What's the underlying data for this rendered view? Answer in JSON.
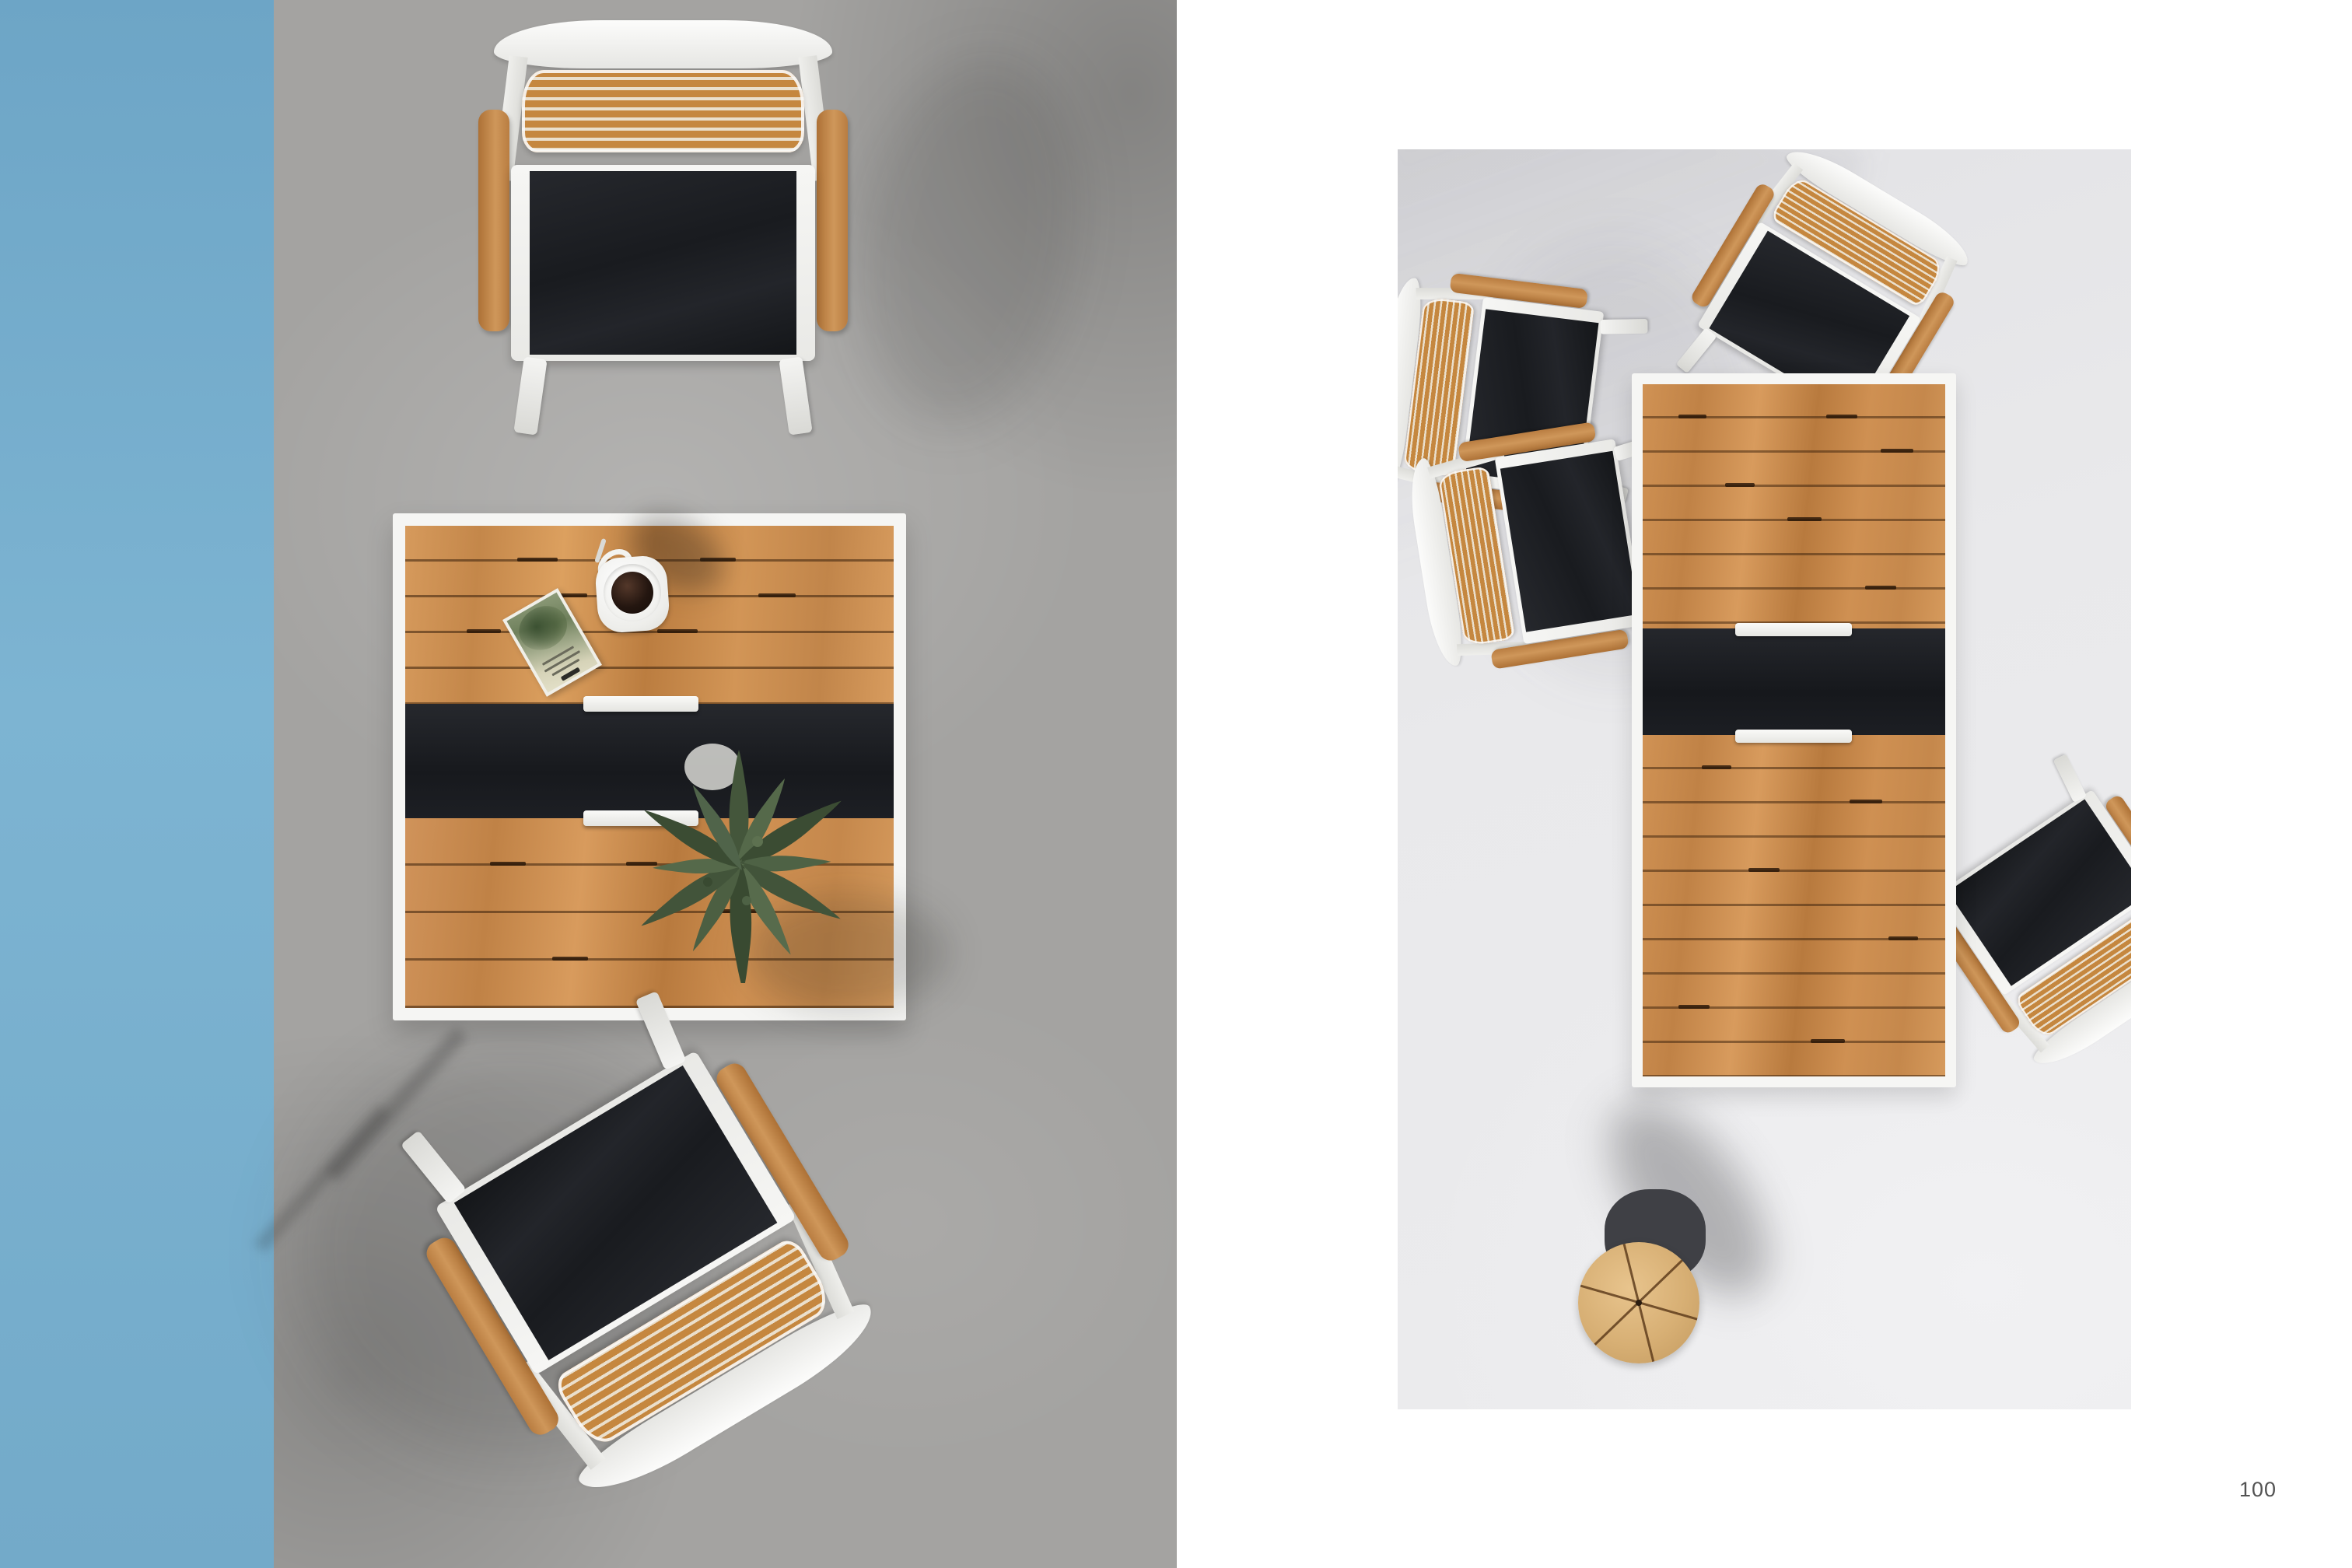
{
  "page": {
    "number": "100"
  },
  "palette": {
    "paper": "#ffffff",
    "blue_wall": "#74adcd",
    "concrete_floor": "#a4a3a1",
    "studio_floor": "#e9e9eb",
    "frame_white": "#f5f5f3",
    "teak_wood": "#c9894a",
    "teak_deep": "#a86b34",
    "sling_black": "#1b1d21",
    "stool_wood": "#ddb377",
    "coffee": "#241610",
    "fern_green": "#44563c"
  },
  "scene_left": {
    "items": [
      "armchair-top",
      "square-dining-table",
      "coffee-cup",
      "book",
      "fern-plant",
      "armchair-bottom-rotated"
    ]
  },
  "scene_right": {
    "items": [
      "rect-dining-table",
      "chair-upper-left",
      "chair-lower-left",
      "chair-top-right",
      "chair-right",
      "round-side-stool"
    ]
  }
}
